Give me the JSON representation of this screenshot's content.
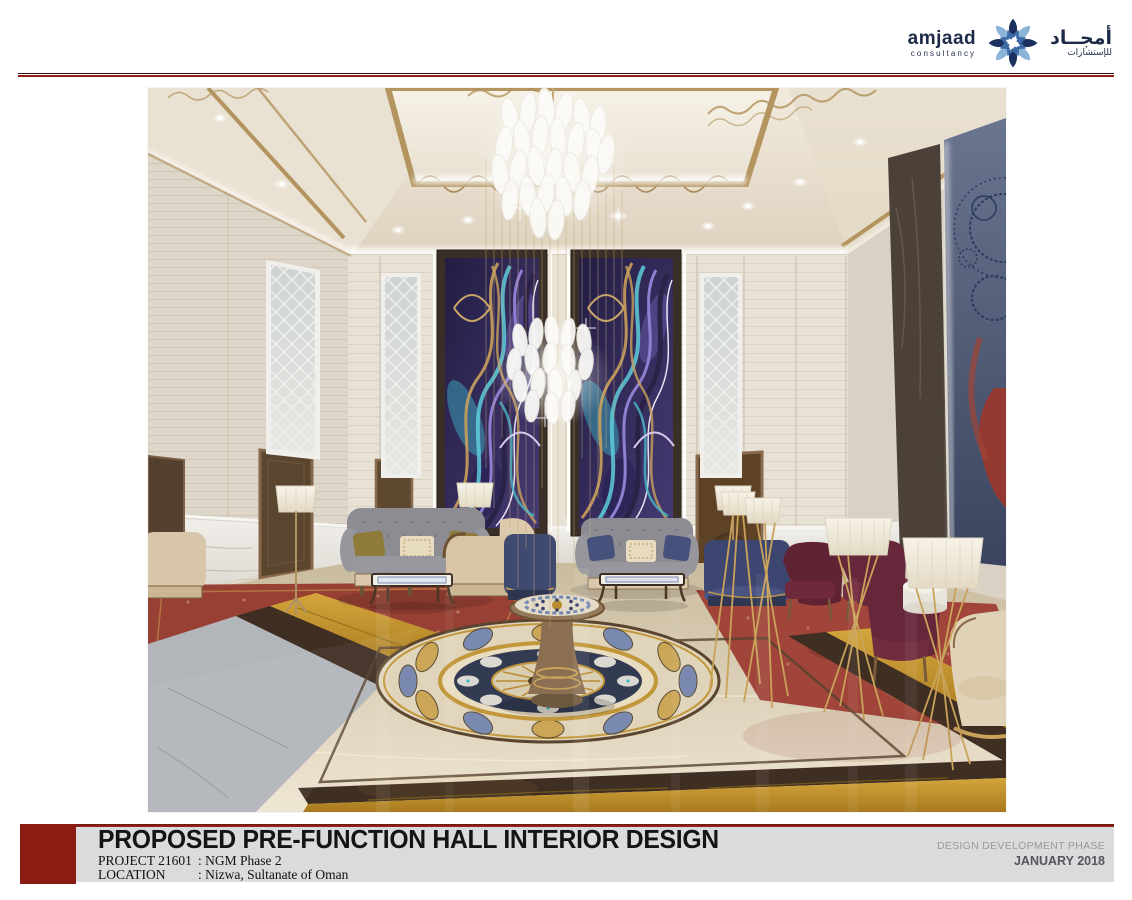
{
  "header": {
    "logo": {
      "latin_name": "amjaad",
      "latin_subtitle": "consultancy",
      "arabic_name": "أمجــاد",
      "arabic_subtitle": "للإستشارات"
    }
  },
  "artwork": {
    "alt": "3D interior rendering of a luxury pre-function hall: ornate gold-trimmed coffered ceiling with crystal leaf chandeliers, two purple-teal-gold abstract marble feature panels, mirrored lattice panels, grey tufted sofas, burgundy armchairs, tripod floor lamps, large blue abstract mural on the right wall, and a cream marble floor with a circular inlaid medallion and central pedestal table"
  },
  "footer": {
    "title": "PROPOSED PRE-FUNCTION HALL INTERIOR DESIGN",
    "project_label": "PROJECT  21601",
    "project_value": ": NGM Phase 2",
    "location_label": "LOCATION",
    "location_value": ": Nizwa, Sultanate of Oman",
    "phase": "DESIGN DEVELOPMENT PHASE",
    "date": "JANUARY 2018"
  },
  "palette": {
    "accent_red": "#8a1c13",
    "bar_grey": "#d9dbdd",
    "logo_navy": "#1d3160",
    "logo_light_blue": "#8ab4d8",
    "logo_mid_blue": "#3c6ba8",
    "ceiling_gold": "#b3945f",
    "floor_gold": "#c9992f"
  }
}
